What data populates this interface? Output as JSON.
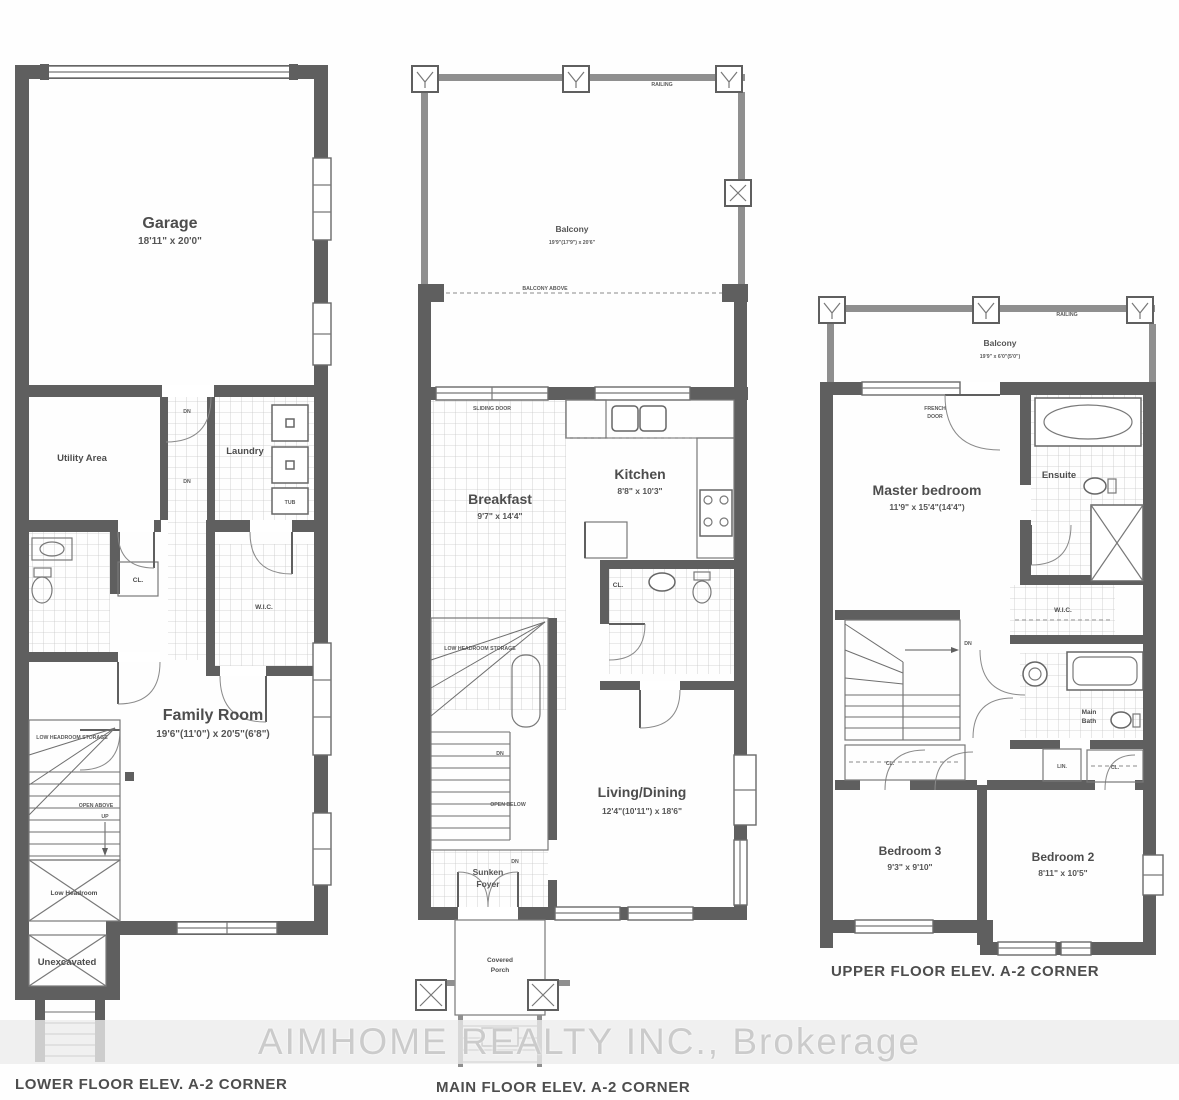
{
  "watermark": {
    "text": "AIMHOME REALTY INC., Brokerage"
  },
  "lower": {
    "caption": "LOWER FLOOR ELEV. A-2 CORNER",
    "garage": {
      "name": "Garage",
      "dims": "18'11\" x 20'0\""
    },
    "utility": {
      "name": "Utility Area"
    },
    "laundry": {
      "name": "Laundry"
    },
    "tub_label": "TUB",
    "cl_label": "CL.",
    "wic_label": "W.I.C.",
    "family": {
      "name": "Family Room",
      "dims": "19'6\"(11'0\") x 20'5\"(6'8\")"
    },
    "storage_label": "LOW HEADROOM STORAGE",
    "open_above_label": "OPEN ABOVE",
    "up_label": "UP",
    "dn_label": "DN",
    "low_headroom_label": "Low Headroom",
    "unexcavated_label": "Unexcavated"
  },
  "main": {
    "caption": "MAIN FLOOR ELEV. A-2 CORNER",
    "railing_label": "RAILING",
    "balcony": {
      "name": "Balcony",
      "dims": "19'9\"(17'9\") x 20'6\""
    },
    "balcony_above_label": "BALCONY ABOVE",
    "sliding_door_label": "SLIDING DOOR",
    "breakfast": {
      "name": "Breakfast",
      "dims": "9'7\" x 14'4\""
    },
    "kitchen": {
      "name": "Kitchen",
      "dims": "8'8\" x 10'3\""
    },
    "living": {
      "name": "Living/Dining",
      "dims": "12'4\"(10'11\") x 18'6\""
    },
    "storage_label": "LOW HEADROOM STORAGE",
    "open_below_label": "OPEN BELOW",
    "cl_label": "CL.",
    "dn_label": "DN",
    "foyer": {
      "line1": "Sunken",
      "line2": "Foyer"
    },
    "porch": {
      "line1": "Covered",
      "line2": "Porch"
    }
  },
  "upper": {
    "caption": "UPPER FLOOR ELEV. A-2 CORNER",
    "railing_label": "RAILING",
    "balcony": {
      "name": "Balcony",
      "dims": "19'9\" x 6'0\"(5'0\")"
    },
    "french_door": {
      "line1": "FRENCH",
      "line2": "DOOR"
    },
    "master": {
      "name": "Master bedroom",
      "dims": "11'9\" x 15'4\"(14'4\")"
    },
    "ensuite": {
      "name": "Ensuite"
    },
    "wic_label": "W.I.C.",
    "main_bath": {
      "line1": "Main",
      "line2": "Bath"
    },
    "lin_label": "LIN.",
    "cl_label": "CL.",
    "cl2_label": "CL.",
    "dn_label": "DN",
    "bedroom3": {
      "name": "Bedroom 3",
      "dims": "9'3\" x 9'10\""
    },
    "bedroom2": {
      "name": "Bedroom 2",
      "dims": "8'11\" x 10'5\""
    }
  }
}
